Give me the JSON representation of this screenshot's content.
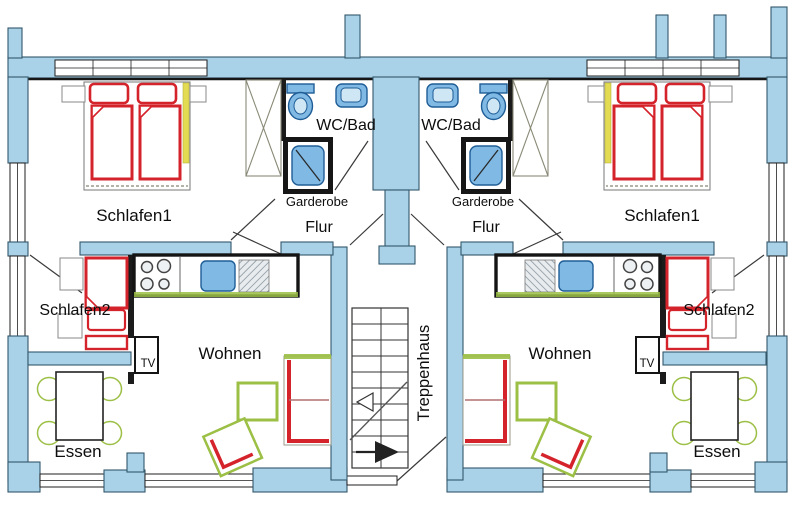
{
  "labels": {
    "schlafen1": "Schlafen1",
    "schlafen2": "Schlafen2",
    "wc_bad": "WC/Bad",
    "garderobe": "Garderobe",
    "flur": "Flur",
    "wohnen": "Wohnen",
    "essen": "Essen",
    "tv": "TV",
    "treppenhaus": "Treppenhaus"
  },
  "colors": {
    "wall_blue": "#a9d1e8",
    "outline_dark": "#1b1b1b",
    "furniture_red": "#d5232b",
    "furniture_green": "#9cbf45",
    "fixture_blue": "#7fb9e4",
    "fixture_blue_dark": "#1f5d96",
    "yellow_accent": "#e3dc52"
  }
}
